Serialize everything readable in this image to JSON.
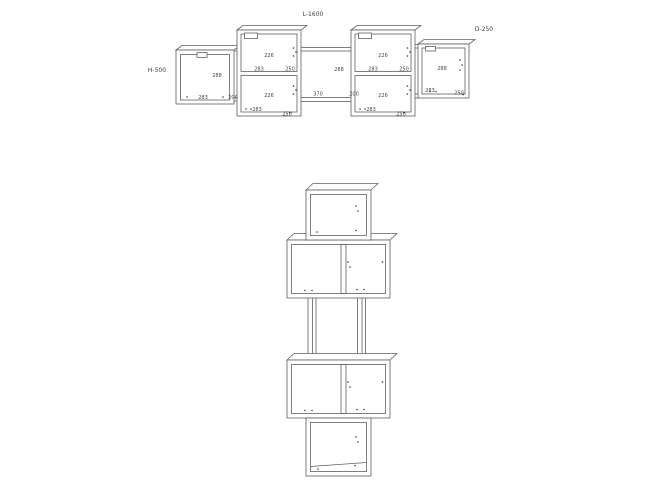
{
  "front_view": {
    "length_label": "L-1600",
    "height_label": "H-500",
    "depth_label": "D-250",
    "left_box": {
      "center": "288",
      "bottom": "283",
      "edge": "200"
    },
    "cabinet_left": {
      "top_cell_height": "226",
      "top_cell_width": "283",
      "top_cell_depth": "250",
      "bottom_cell_height": "226",
      "bottom_cell_width": "283",
      "bottom_cell_depth": "250"
    },
    "middle_opening": {
      "height": "288",
      "width": "370",
      "edge": "200"
    },
    "cabinet_right": {
      "top_cell_height": "226",
      "top_cell_width": "283",
      "top_cell_depth": "250",
      "bottom_cell_height": "226",
      "bottom_cell_width": "283",
      "bottom_cell_depth": "250"
    },
    "right_box": {
      "center": "288",
      "bottom": "283",
      "edge": "250"
    }
  }
}
